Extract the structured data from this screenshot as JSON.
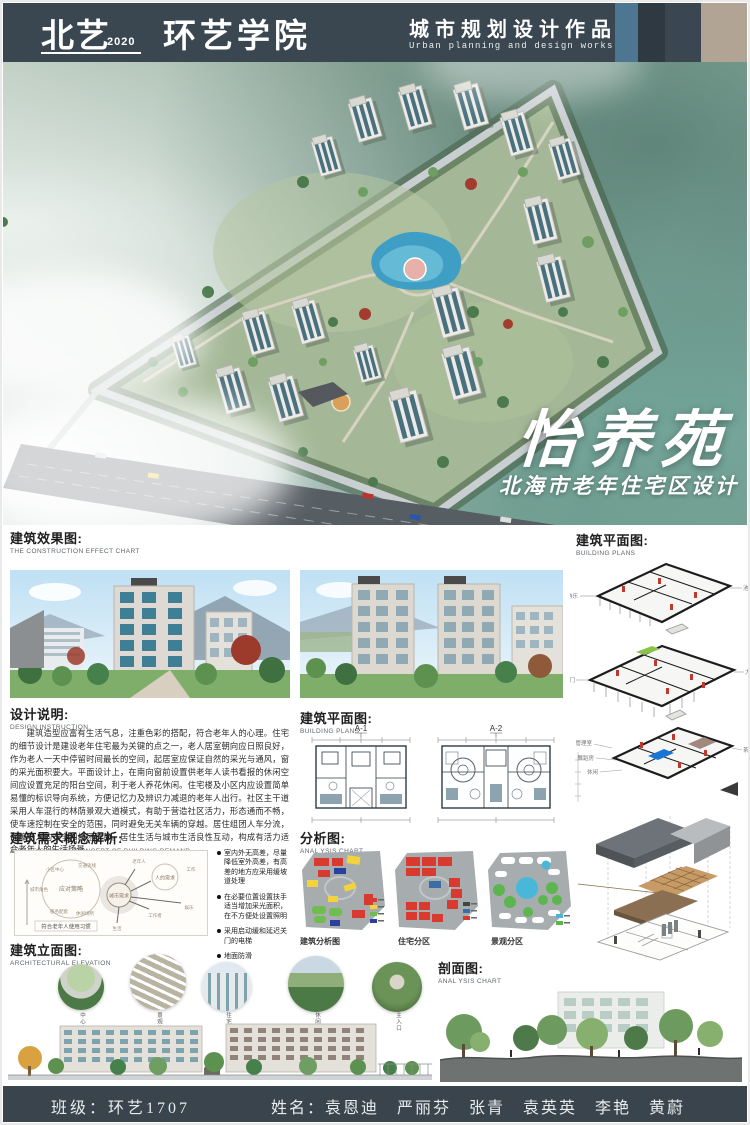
{
  "colors": {
    "header_bg": "#3a4750",
    "stripe_blue": "#4d7691",
    "stripe_beige": "#b1a495",
    "analysis_red": "#d93a30",
    "analysis_yellow": "#f2d33c",
    "analysis_green": "#6fbd4e",
    "analysis_blue": "#2b3f9e",
    "analysis_cyan": "#49b8d8",
    "pond_blue": "#3f9ec4"
  },
  "header": {
    "logo_main": "北艺",
    "logo_year": "2020",
    "logo_dept": "环艺学院",
    "title_cn": "城市规划设计作品",
    "title_en": "Urban planning and design works"
  },
  "hero": {
    "title": "怡养苑",
    "subtitle": "北海市老年住宅区设计"
  },
  "effect_section": {
    "title_cn": "建筑效果图:",
    "title_en": "THE CONSTRUCTION EFFECT CHART"
  },
  "design_section": {
    "title_cn": "设计说明:",
    "title_en": "DESIGN INSTRUCTION",
    "paragraph": "建筑造型应富有生活气息，注重色彩的搭配，符合老年人的心理。住宅的细节设计是建设老年住宅最为关键的点之一，老人居室朝向应日照良好，作为老人一天中停留时间最长的空间，起居室应保证自然的采光与通风，窗的采光面积要大。平面设计上，在南向窗前设置供老年人读书看报的休闲空间应设置充足的阳台空间，利于老人养花休闲。住宅楼及小区内应设置简单易懂的标识导向系统，方便记忆力及辨识力减退的老年人出行。社区主干道采用人车混行的林荫景观大道模式，有助于营造社区活力，形态通而不畅，使车速控制在安全的范围，同时避免无关车辆的穿越。居住组团人车分流，保障老人的安全和组团宁静。居住生活与城市生活良性互动，构成有活力适合老年人的生活场景。"
  },
  "plans_mid_section": {
    "title_cn": "建筑平面图:",
    "title_en": "BUILDING PLANS",
    "plan_labels": [
      "A-1",
      "A-2"
    ]
  },
  "analysis_section": {
    "title_cn": "分析图:",
    "title_en": "ANAL YSIS CHART",
    "captions": [
      "建筑分析图",
      "住宅分区",
      "景观分区"
    ]
  },
  "demand_section": {
    "title_cn": "建筑需求概念解析:",
    "title_en": "ANALYSIS OF THE CONCEPT OF BUILDING DEMAND",
    "bubble": {
      "center": "城市需求",
      "strategy": "应对策略",
      "strategy_nodes": [
        "小区中心",
        "城市角色",
        "服务配套",
        "交通流线",
        "休闲场所"
      ],
      "need": "人的需求",
      "need_nodes": [
        "老年人",
        "工作者",
        "生活",
        "娱乐",
        "工作"
      ],
      "caption": "符合老年人使用习惯"
    },
    "bullets": [
      "室内外无高差，尽量降低室外高差，有高差的地方应采用缓坡道处理",
      "在必要位置设置扶手适当增加采光面积，在不方便处设置照明",
      "采用启动缓和延迟关门的电梯",
      "地面防滑"
    ]
  },
  "elevation_section": {
    "title_cn": "建筑立面图:",
    "title_en": "ARCHITECTURAL ELEVATION",
    "inset_labels": [
      "中心广场",
      "景观构架",
      "住宅立面",
      "休闲大道",
      "主入口"
    ]
  },
  "plans_right_section": {
    "title_cn": "建筑平面图:",
    "title_en": "BUILDING PLANS",
    "plan1_labels": [
      "游乐",
      "池区"
    ],
    "plan2_labels": [
      "侧门",
      "大厅"
    ],
    "plan3_labels": [
      "管理室",
      "舞蹈房",
      "休闲",
      "茶室"
    ]
  },
  "profile_section": {
    "title_cn": "剖面图:",
    "title_en": "ANAL YSIS CHART"
  },
  "footer": {
    "class_info": "班级：环艺1707",
    "names": "姓名：袁恩迪　严丽芬　张青　袁英英　李艳　黄蔚"
  }
}
